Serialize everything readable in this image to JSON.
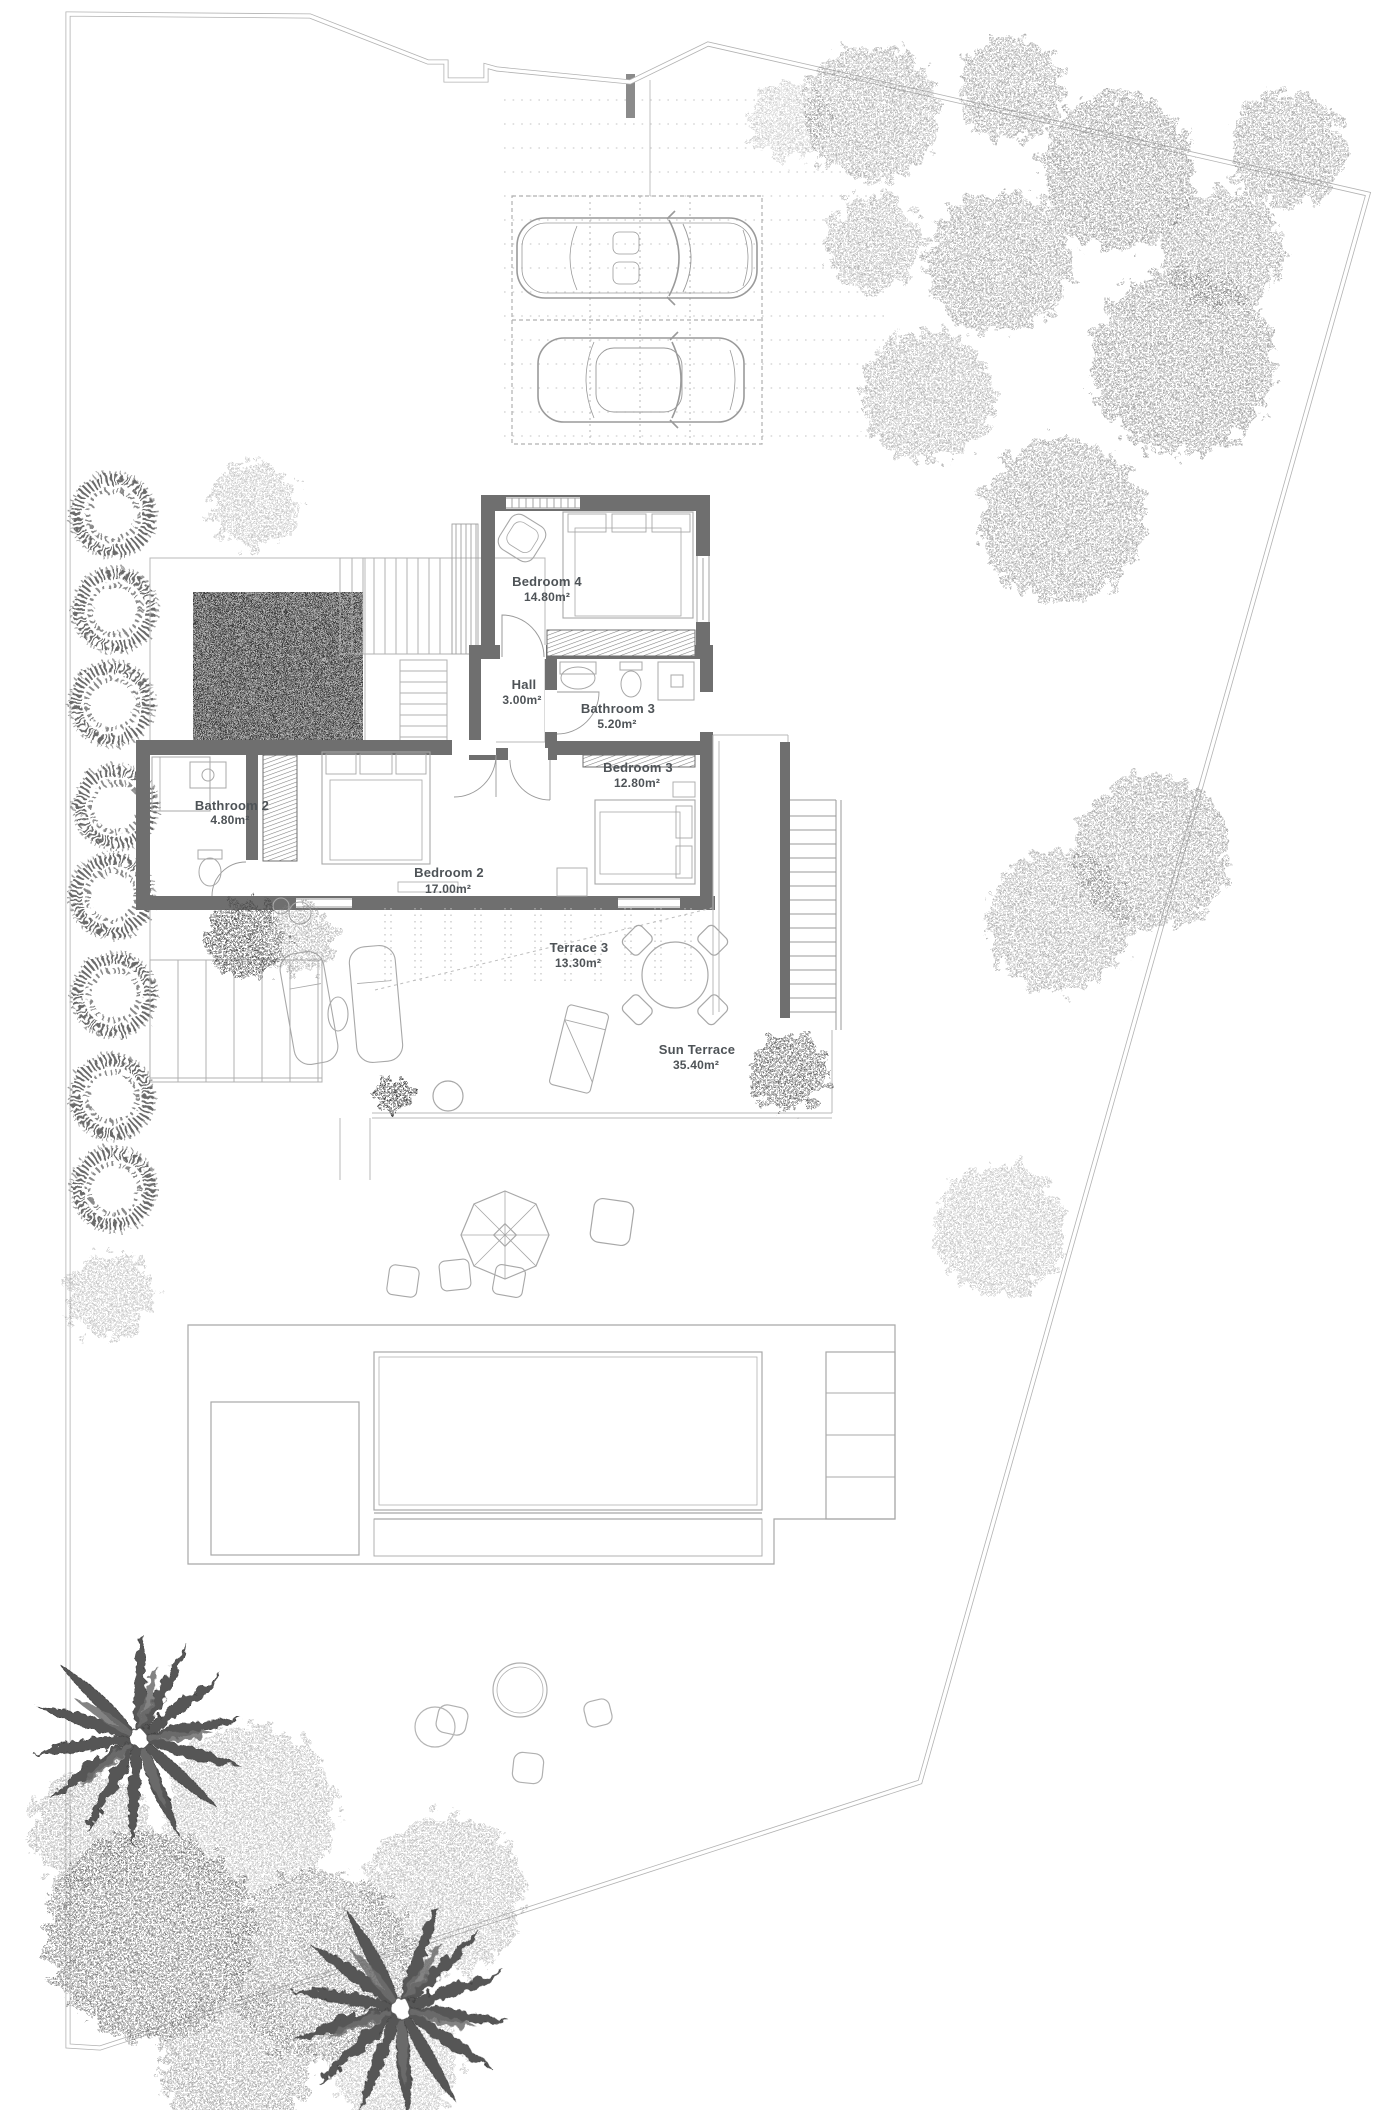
{
  "plan": {
    "kind": "villa-upper-floor-site-plan",
    "rooms": [
      {
        "name": "Bedroom 4",
        "area": "14.80m²"
      },
      {
        "name": "Hall",
        "area": "3.00m²"
      },
      {
        "name": "Bathroom 3",
        "area": "5.20m²"
      },
      {
        "name": "Bedroom 3",
        "area": "12.80m²"
      },
      {
        "name": "Bathroom 2",
        "area": "4.80m²"
      },
      {
        "name": "Bedroom 2",
        "area": "17.00m²"
      }
    ],
    "outdoor_areas": [
      {
        "name": "Terrace 3",
        "area": "13.30m²"
      },
      {
        "name": "Sun Terrace",
        "area": "35.40m²"
      }
    ]
  },
  "colors": {
    "background": "#ffffff",
    "wall": "#6f6f6f",
    "line": "#9a9a9a",
    "light_line": "#c2c2c2",
    "text": "#4e5357",
    "foliage": "#7d7d7d"
  }
}
